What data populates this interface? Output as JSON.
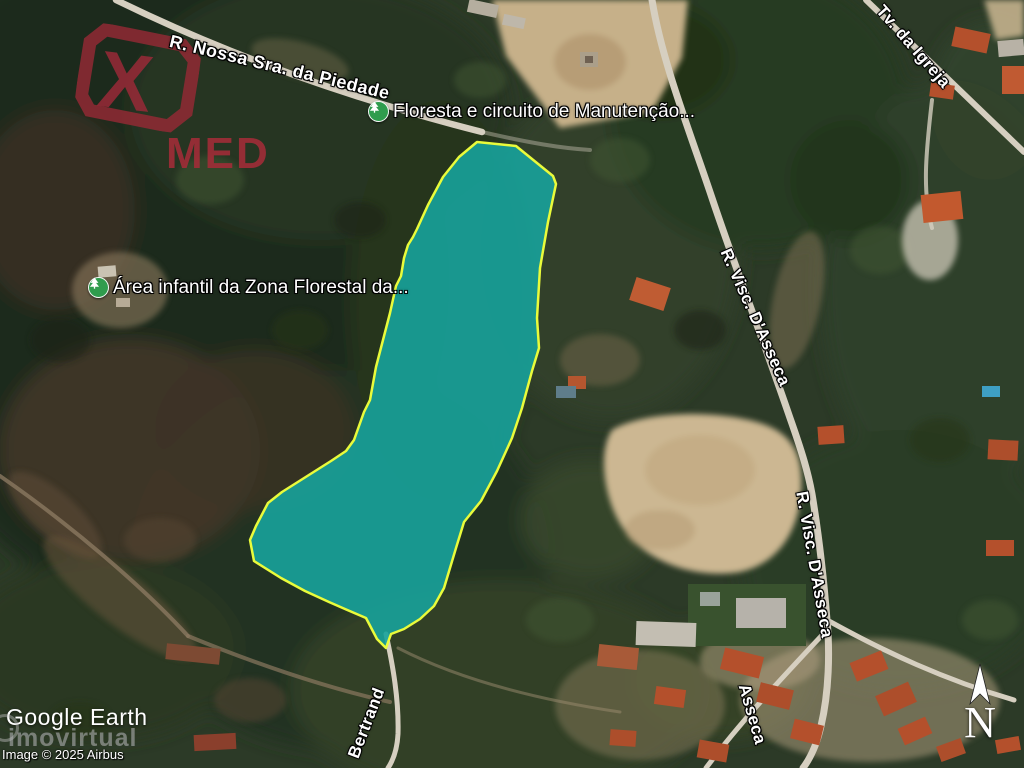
{
  "branding": {
    "x": "X",
    "med": "MED",
    "color": "#9e2a38"
  },
  "labels": {
    "roads": [
      {
        "text": "R. Nossa Sra. da Piedade"
      },
      {
        "text": "Tv. da Igreja"
      },
      {
        "text": "R. Visc. D'Asseca"
      },
      {
        "text": "R. Visc. D'Asseca"
      },
      {
        "text": "Asseca"
      },
      {
        "text": "Bertrand"
      }
    ],
    "pois": [
      {
        "text": "Floresta e circuito de Manutenção...",
        "icon": "tree-icon"
      },
      {
        "text": "Área infantil da Zona Florestal da...",
        "icon": "tree-icon"
      }
    ]
  },
  "parcel": {
    "points": "477,142 516,146 553,176 556,184 548,222 540,268 537,318 539,348 532,371 522,408 512,438 497,471 481,501 464,522 456,548 444,588 434,606 420,619 404,629 391,634 386,648 377,639 366,618 345,609 329,602 305,591 281,578 254,561 250,540 256,526 268,503 282,492 331,461 346,451 354,440 364,412 370,400 376,367 383,340 390,313 396,286 401,276 404,258 408,245 413,237 417,229 428,205 443,177 459,157",
    "fill": "#17a29b",
    "stroke": "#e9fb3b",
    "fill_opacity": "0.9"
  },
  "attribution": {
    "provider": "Google Earth",
    "watermark": "imovirtual",
    "copyright": "Image © 2025 Airbus"
  },
  "compass": {
    "label": "N"
  }
}
